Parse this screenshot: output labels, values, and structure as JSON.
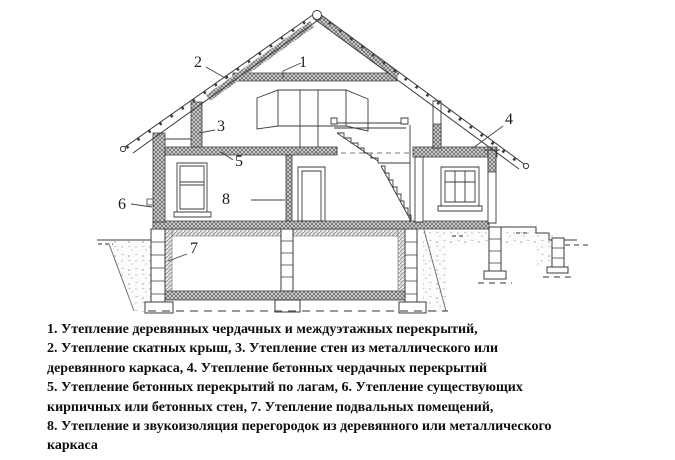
{
  "diagram": {
    "callouts": [
      {
        "number": "1"
      },
      {
        "number": "2"
      },
      {
        "number": "3"
      },
      {
        "number": "4"
      },
      {
        "number": "5"
      },
      {
        "number": "6"
      },
      {
        "number": "7"
      },
      {
        "number": "8"
      }
    ]
  },
  "legend": {
    "lines": [
      "1. Утепление деревянных чердачных и междуэтажных перекрытий,",
      "2. Утепление скатных крыш, 3. Утепление стен из металлического или",
      "деревянного каркаса, 4. Утепление бетонных чердачных перекрытий",
      "5. Утепление бетонных перекрытий по лагам, 6. Утепление существующих",
      "кирпичных или бетонных стен, 7. Утепление подвальных помещений,",
      "8. Утепление и звукоизоляция перегородок из деревянного или металлического",
      "каркаса"
    ]
  },
  "colors": {
    "ink": "#3b3b3b",
    "text": "#0e0e0e",
    "background": "#ffffff"
  }
}
